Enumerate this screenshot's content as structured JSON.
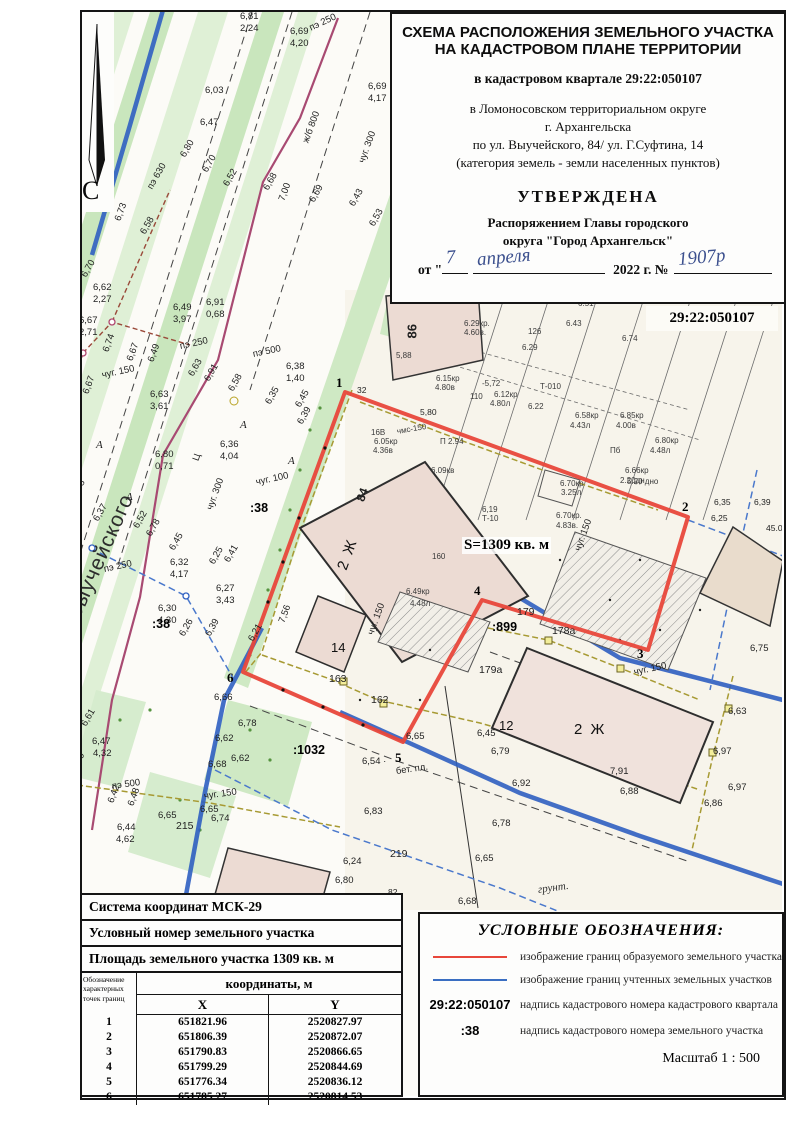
{
  "doc": {
    "title_line1": "СХЕМА РАСПОЛОЖЕНИЯ ЗЕМЕЛЬНОГО УЧАСТКА",
    "title_line2": "НА КАДАСТРОВОМ ПЛАНЕ ТЕРРИТОРИИ",
    "quarter_line": "в кадастровом квартале 29:22:050107",
    "district_line1": "в Ломоносовском территориальном округе",
    "district_line2": "г. Архангельска",
    "address_line": "по ул. Выучейского, 84/ ул. Г.Суфтина, 14",
    "category_line": "(категория земель - земли населенных пунктов)",
    "approved": "УТВЕРЖДЕНА",
    "order_line1": "Распоряжением Главы городского",
    "order_line2": "округа \"Город Архангельск\"",
    "date_prefix": "от \"",
    "date_mid": "2022 г. №",
    "hw_day": "7",
    "hw_month": "апреля",
    "hw_number": "1907р"
  },
  "map": {
    "quarter_label": "29:22:050107",
    "street_name": "Выучейского",
    "north_letter": "С",
    "area_label": "S=1309 кв. м",
    "labels": [
      [
        "6,81",
        240,
        12,
        ""
      ],
      [
        "2,24",
        240,
        24,
        ""
      ],
      [
        "6,69",
        290,
        27,
        ""
      ],
      [
        "4,20",
        290,
        39,
        ""
      ],
      [
        "пэ 250",
        310,
        24,
        "r25"
      ],
      [
        "6,03",
        205,
        86,
        ""
      ],
      [
        "6,47",
        200,
        118,
        ""
      ],
      [
        "ж/б 800",
        306,
        138,
        "r70"
      ],
      [
        "6,80",
        183,
        152,
        "r60"
      ],
      [
        "6,70",
        205,
        167,
        "r60"
      ],
      [
        "пэ 630",
        150,
        184,
        "r60"
      ],
      [
        "6,52",
        226,
        181,
        "r60"
      ],
      [
        "6,68",
        266,
        185,
        "r60"
      ],
      [
        "7,00",
        282,
        196,
        "r70"
      ],
      [
        "чуг. 300",
        362,
        158,
        "r70"
      ],
      [
        "6,73",
        118,
        216,
        "r70"
      ],
      [
        "6,58",
        143,
        229,
        "r60"
      ],
      [
        "6,69",
        312,
        197,
        "r60"
      ],
      [
        "6,43",
        352,
        201,
        "r60"
      ],
      [
        "6,53",
        372,
        221,
        "r60"
      ],
      [
        "6,70",
        84,
        272,
        "r60"
      ],
      [
        "6,62",
        93,
        283,
        ""
      ],
      [
        "2,27",
        93,
        295,
        ""
      ],
      [
        "6,49",
        173,
        303,
        ""
      ],
      [
        "3,97",
        173,
        315,
        ""
      ],
      [
        "6,91",
        206,
        298,
        ""
      ],
      [
        "0,68",
        206,
        310,
        ""
      ],
      [
        "6,67",
        79,
        316,
        ""
      ],
      [
        "2,71",
        79,
        328,
        ""
      ],
      [
        "пэ 250",
        180,
        342,
        "r12"
      ],
      [
        "пэ 500",
        253,
        350,
        "r12"
      ],
      [
        "6,74",
        106,
        347,
        "r70"
      ],
      [
        "6,67",
        130,
        356,
        "r70"
      ],
      [
        "6,49",
        151,
        357,
        "r70"
      ],
      [
        "чуг. 150",
        102,
        371,
        "r12"
      ],
      [
        "6,67",
        86,
        389,
        "r70"
      ],
      [
        "6,63",
        150,
        390,
        ""
      ],
      [
        "3,61",
        150,
        402,
        ""
      ],
      [
        "6,63",
        191,
        371,
        "r60"
      ],
      [
        "6,91",
        207,
        376,
        "r60"
      ],
      [
        "6,58",
        231,
        386,
        "r60"
      ],
      [
        "6,38",
        286,
        362,
        ""
      ],
      [
        "1,40",
        286,
        374,
        ""
      ],
      [
        "6,69",
        368,
        82,
        ""
      ],
      [
        "4,17",
        368,
        94,
        ""
      ],
      [
        "1",
        336,
        376,
        "vx"
      ],
      [
        "32",
        357,
        386,
        "dim"
      ],
      [
        "6,35",
        268,
        399,
        "r60"
      ],
      [
        "6,45",
        298,
        402,
        "r60"
      ],
      [
        "6,39",
        300,
        419,
        "r60"
      ],
      [
        "5,80",
        420,
        408,
        "dim"
      ],
      [
        "6,36",
        220,
        440,
        ""
      ],
      [
        "4,04",
        220,
        452,
        ""
      ],
      [
        "Ц",
        196,
        456,
        "r70"
      ],
      [
        "А",
        96,
        440,
        "ital"
      ],
      [
        "А",
        126,
        492,
        "ital"
      ],
      [
        "А",
        240,
        420,
        "ital"
      ],
      [
        "А",
        288,
        456,
        "ital"
      ],
      [
        "6,80",
        155,
        450,
        ""
      ],
      [
        "0,71",
        155,
        462,
        ""
      ],
      [
        "86",
        412,
        332,
        "r90b"
      ],
      [
        "6.29кр.",
        464,
        320,
        "hw"
      ],
      [
        "4.60в.",
        464,
        329,
        "hw"
      ],
      [
        "126",
        528,
        328,
        "hw"
      ],
      [
        "6.29",
        522,
        344,
        "hw"
      ],
      [
        "6.51",
        578,
        300,
        "hw"
      ],
      [
        "6.43",
        566,
        320,
        "hw"
      ],
      [
        "6.74",
        622,
        335,
        "hw"
      ],
      [
        "5,88",
        396,
        352,
        "hw"
      ],
      [
        "6.15кр",
        436,
        375,
        "hw"
      ],
      [
        "4.80в",
        435,
        384,
        "hw"
      ],
      [
        "-5,72",
        482,
        380,
        "hw"
      ],
      [
        "6.12кр",
        494,
        391,
        "hw"
      ],
      [
        "4.80л",
        490,
        400,
        "hw"
      ],
      [
        "110",
        470,
        393,
        "hw"
      ],
      [
        "6.22",
        528,
        403,
        "hw"
      ],
      [
        "Т-010",
        540,
        383,
        "hw"
      ],
      [
        "6.58кр",
        575,
        412,
        "hw"
      ],
      [
        "4.43л",
        570,
        422,
        "hw"
      ],
      [
        "6.85кр",
        620,
        412,
        "hw"
      ],
      [
        "4.00в",
        616,
        422,
        "hw"
      ],
      [
        "6.80кр",
        655,
        437,
        "hw"
      ],
      [
        "4.48л",
        650,
        447,
        "hw"
      ],
      [
        "6.66кр",
        625,
        467,
        "hw"
      ],
      [
        "2.20дн",
        620,
        477,
        "hw"
      ],
      [
        "Пб",
        610,
        447,
        "hw"
      ],
      [
        "П 2.94",
        440,
        438,
        "hw"
      ],
      [
        "чмс-150",
        397,
        428,
        "hwr"
      ],
      [
        "6.09кв",
        431,
        467,
        "hw"
      ],
      [
        "16В",
        371,
        429,
        "hw"
      ],
      [
        "6.05кр",
        374,
        438,
        "hw"
      ],
      [
        "4.36в",
        373,
        447,
        "hw"
      ],
      [
        "6.70кр",
        560,
        480,
        "hw"
      ],
      [
        "3.25л",
        561,
        489,
        "hw"
      ],
      [
        "5.20 дно",
        627,
        478,
        "hw"
      ],
      [
        "6.70кр.",
        556,
        512,
        "hw"
      ],
      [
        "4.83в.",
        556,
        522,
        "hw"
      ],
      [
        "6,19",
        482,
        506,
        "hw"
      ],
      [
        "Т-10",
        482,
        515,
        "hw"
      ],
      [
        "160",
        432,
        553,
        "hw"
      ],
      [
        "6,35",
        714,
        498,
        "dim"
      ],
      [
        "6,39",
        754,
        498,
        "dim"
      ],
      [
        "6,25",
        711,
        514,
        "dim"
      ],
      [
        "45.0",
        766,
        524,
        "dim"
      ],
      [
        "84",
        360,
        495,
        "r70b"
      ],
      [
        "6,58",
        74,
        492,
        "r60"
      ],
      [
        "6,37",
        96,
        516,
        "r60"
      ],
      [
        "чуг. 300",
        210,
        505,
        "r70"
      ],
      [
        "6,52",
        136,
        523,
        "r60"
      ],
      [
        "6,78",
        149,
        531,
        "r60"
      ],
      [
        "6,45",
        172,
        545,
        "r60"
      ],
      [
        "чуг. 100",
        256,
        478,
        "r12"
      ],
      [
        ":38",
        250,
        502,
        "kn"
      ],
      [
        "S=1309 кв. м",
        462,
        537,
        "area"
      ],
      [
        "чуг. 150",
        578,
        546,
        "r70"
      ],
      [
        "2 Ж",
        342,
        562,
        "bld16r"
      ],
      [
        "6,25",
        212,
        559,
        "r60"
      ],
      [
        "6,41",
        227,
        557,
        "r60"
      ],
      [
        "6,32",
        170,
        558,
        ""
      ],
      [
        "4,17",
        170,
        570,
        ""
      ],
      [
        "пэ 250",
        104,
        565,
        "r12"
      ],
      [
        "6,27",
        216,
        584,
        ""
      ],
      [
        "3,43",
        216,
        596,
        ""
      ],
      [
        "6,30",
        158,
        604,
        ""
      ],
      [
        "4,30",
        158,
        616,
        ""
      ],
      [
        ":38",
        152,
        618,
        "kn"
      ],
      [
        "6,26",
        182,
        631,
        "r60"
      ],
      [
        "6,39",
        208,
        631,
        "r60"
      ],
      [
        "2",
        682,
        500,
        "vx"
      ],
      [
        "4",
        474,
        584,
        "vx"
      ],
      [
        "179",
        517,
        607,
        "dim11"
      ],
      [
        ":899",
        492,
        621,
        "kn"
      ],
      [
        "178а",
        552,
        626,
        "dim11"
      ],
      [
        "179а",
        479,
        665,
        "dim11"
      ],
      [
        "6.49кр",
        406,
        588,
        "hw"
      ],
      [
        "4.48л",
        410,
        600,
        "hw"
      ],
      [
        "7,56",
        282,
        618,
        "r70"
      ],
      [
        "6,21",
        251,
        636,
        "r60"
      ],
      [
        "14",
        331,
        641,
        "bld13"
      ],
      [
        "3",
        637,
        647,
        "vx"
      ],
      [
        "чуг. 150",
        634,
        668,
        "r12"
      ],
      [
        "6,75",
        750,
        644,
        ""
      ],
      [
        "163",
        329,
        674,
        "dim11"
      ],
      [
        "162",
        371,
        695,
        "dim11"
      ],
      [
        "6",
        227,
        671,
        "vx"
      ],
      [
        "6,66",
        214,
        693,
        ""
      ],
      [
        "чуг. 150",
        371,
        630,
        "r70"
      ],
      [
        "12",
        499,
        719,
        "bld13"
      ],
      [
        "2 Ж",
        574,
        722,
        "bld16"
      ],
      [
        "6,63",
        728,
        707,
        ""
      ],
      [
        "6,45",
        477,
        729,
        ""
      ],
      [
        "6,78",
        238,
        719,
        ""
      ],
      [
        "6,62",
        215,
        734,
        ""
      ],
      [
        "6,79",
        491,
        747,
        ""
      ],
      [
        "6,97",
        713,
        747,
        ""
      ],
      [
        "6,62",
        231,
        754,
        ""
      ],
      [
        "6,68",
        208,
        760,
        ""
      ],
      [
        ":1032",
        293,
        744,
        "kn"
      ],
      [
        "6,65",
        406,
        732,
        ""
      ],
      [
        "5",
        395,
        751,
        "vx"
      ],
      [
        "6,54 ·",
        362,
        757,
        ""
      ],
      [
        "бет. пл.",
        396,
        767,
        "r8"
      ],
      [
        "6,92",
        512,
        779,
        ""
      ],
      [
        "7,91",
        610,
        767,
        ""
      ],
      [
        "6,97",
        728,
        783,
        ""
      ],
      [
        "6,88",
        620,
        787,
        ""
      ],
      [
        "6,86",
        704,
        799,
        ""
      ],
      [
        "6,61",
        84,
        721,
        "r60"
      ],
      [
        "6,47",
        92,
        737,
        ""
      ],
      [
        "4,32",
        93,
        749,
        ""
      ],
      [
        "6,59",
        76,
        766,
        "r70"
      ],
      [
        "пэ 500",
        112,
        782,
        "r8"
      ],
      [
        "6,42",
        111,
        798,
        "r70"
      ],
      [
        "6,48",
        131,
        801,
        "r70"
      ],
      [
        "чуг. 150",
        204,
        792,
        "r8"
      ],
      [
        "6,65",
        158,
        811,
        ""
      ],
      [
        "6,65",
        200,
        805,
        ""
      ],
      [
        "6,74",
        211,
        814,
        ""
      ],
      [
        "215",
        176,
        821,
        "dim11"
      ],
      [
        "6,44",
        117,
        823,
        ""
      ],
      [
        "4,62",
        116,
        835,
        ""
      ],
      [
        "6,83",
        364,
        807,
        ""
      ],
      [
        "6,78",
        492,
        819,
        ""
      ],
      [
        "219",
        390,
        849,
        "dim11"
      ],
      [
        "6,24",
        343,
        857,
        ""
      ],
      [
        "6,65",
        475,
        854,
        ""
      ],
      [
        "6,80",
        335,
        876,
        ""
      ],
      [
        "грунт.",
        538,
        884,
        "grunt"
      ],
      [
        "6,68",
        458,
        897,
        ""
      ],
      [
        "82",
        388,
        888,
        "dim"
      ]
    ]
  },
  "table": {
    "row1": "Система координат МСК-29",
    "row2": "Условный номер земельного участка",
    "row3": "Площадь земельного участка 1309 кв. м",
    "col_point": "Обозначение характерных точек границ",
    "col_coords": "координаты, м",
    "col_x": "X",
    "col_y": "Y",
    "rows": [
      [
        "1",
        "651821.96",
        "2520827.97"
      ],
      [
        "2",
        "651806.39",
        "2520872.07"
      ],
      [
        "3",
        "651790.83",
        "2520866.65"
      ],
      [
        "4",
        "651799.29",
        "2520844.69"
      ],
      [
        "5",
        "651776.34",
        "2520836.12"
      ],
      [
        "6",
        "651785.27",
        "2520814.53"
      ]
    ]
  },
  "legend": {
    "title": "УСЛОВНЫЕ ОБОЗНАЧЕНИЯ:",
    "items": [
      {
        "type": "red-line",
        "text": "изображение границ образуемого земельного участка"
      },
      {
        "type": "blue-line",
        "text": "изображение границ учтенных земельных участков"
      },
      {
        "type": "text",
        "sample": "29:22:050107",
        "text": "надпись кадастрового номера кадастрового квартала"
      },
      {
        "type": "text",
        "sample": ":38",
        "text": "надпись кадастрового номера земельного участка"
      }
    ],
    "scale": "Масштаб  1 : 500"
  },
  "colors": {
    "parcel_new_boundary": "#e8473b",
    "parcel_registered_boundary": "#3a6ec2",
    "vegetation": "#c9e6bd",
    "building_fill": "#ecdbd3"
  }
}
